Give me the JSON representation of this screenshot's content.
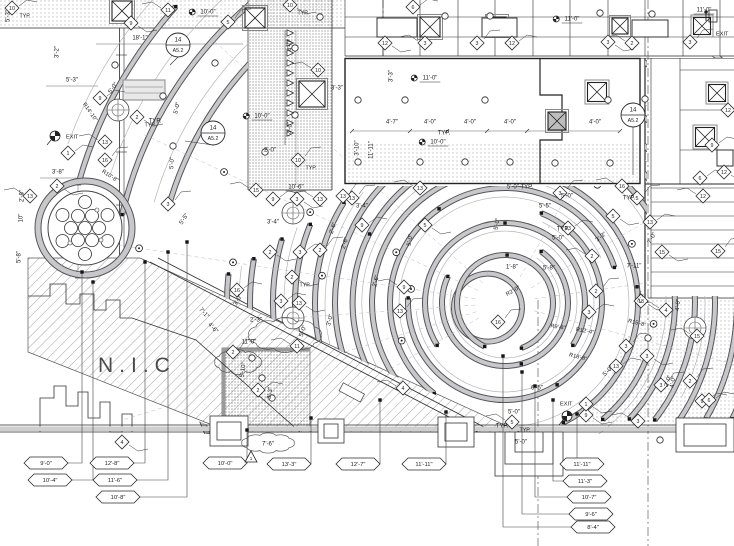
{
  "labels": {
    "nic": "N.I.C",
    "typ": "TYP."
  },
  "revision": {
    "dim": "7'-6\"",
    "delta": "1"
  },
  "detail_tags": [
    {
      "num": "14",
      "sheet": "A5.2",
      "x": 178,
      "y": 45
    },
    {
      "num": "14",
      "sheet": "A5.2",
      "x": 213,
      "y": 133
    },
    {
      "num": "14",
      "sheet": "A5.2",
      "x": 633,
      "y": 115
    }
  ],
  "exits": [
    {
      "label": "EXIT",
      "x": 66,
      "y": 137,
      "sx": 55,
      "sy": 136,
      "style": "dot"
    },
    {
      "label": "EXIT",
      "x": 560,
      "y": 404,
      "sx": 567,
      "sy": 416,
      "style": "dot"
    },
    {
      "label": "EXIT",
      "x": 716,
      "y": 34,
      "sx": 712,
      "sy": 16,
      "style": "person"
    }
  ],
  "diamonds": [
    {
      "n": "10",
      "x": 12,
      "y": 8,
      "typ": true
    },
    {
      "n": "9",
      "x": 131,
      "y": 23
    },
    {
      "n": "11",
      "x": 168,
      "y": 10
    },
    {
      "n": "5",
      "x": 228,
      "y": 22
    },
    {
      "n": "6",
      "x": 413,
      "y": 7
    },
    {
      "n": "12",
      "x": 385,
      "y": 43
    },
    {
      "n": "3",
      "x": 425,
      "y": 43
    },
    {
      "n": "3",
      "x": 477,
      "y": 43
    },
    {
      "n": "12",
      "x": 512,
      "y": 43
    },
    {
      "n": "3",
      "x": 608,
      "y": 42
    },
    {
      "n": "2",
      "x": 632,
      "y": 43
    },
    {
      "n": "3",
      "x": 690,
      "y": 42
    },
    {
      "n": "12",
      "x": 728,
      "y": 110
    },
    {
      "n": "10",
      "x": 290,
      "y": 5,
      "typ": true
    },
    {
      "n": "10",
      "x": 318,
      "y": 70
    },
    {
      "n": "10",
      "x": 298,
      "y": 160,
      "typ": true
    },
    {
      "n": "9",
      "x": 273,
      "y": 199
    },
    {
      "n": "3",
      "x": 297,
      "y": 199
    },
    {
      "n": "13",
      "x": 320,
      "y": 199
    },
    {
      "n": "13",
      "x": 352,
      "y": 198
    },
    {
      "n": "9",
      "x": 100,
      "y": 98
    },
    {
      "n": "2",
      "x": 137,
      "y": 117,
      "typ": true
    },
    {
      "n": "13",
      "x": 105,
      "y": 142
    },
    {
      "n": "16",
      "x": 105,
      "y": 160
    },
    {
      "n": "1",
      "x": 68,
      "y": 153
    },
    {
      "n": "2",
      "x": 57,
      "y": 186
    },
    {
      "n": "13",
      "x": 30,
      "y": 196
    },
    {
      "n": "3",
      "x": 168,
      "y": 204
    },
    {
      "n": "16",
      "x": 237,
      "y": 290
    },
    {
      "n": "2",
      "x": 270,
      "y": 252
    },
    {
      "n": "15",
      "x": 256,
      "y": 190
    },
    {
      "n": "13",
      "x": 343,
      "y": 196
    },
    {
      "n": "9",
      "x": 362,
      "y": 225
    },
    {
      "n": "5",
      "x": 425,
      "y": 225
    },
    {
      "n": "13",
      "x": 420,
      "y": 188
    },
    {
      "n": "2",
      "x": 320,
      "y": 250
    },
    {
      "n": "3",
      "x": 300,
      "y": 252
    },
    {
      "n": "2",
      "x": 292,
      "y": 277,
      "typ": true
    },
    {
      "n": "9",
      "x": 404,
      "y": 287
    },
    {
      "n": "13",
      "x": 400,
      "y": 311
    },
    {
      "n": "3",
      "x": 281,
      "y": 301
    },
    {
      "n": "13",
      "x": 299,
      "y": 303
    },
    {
      "n": "11",
      "x": 297,
      "y": 346
    },
    {
      "n": "2",
      "x": 233,
      "y": 352
    },
    {
      "n": "2",
      "x": 258,
      "y": 390
    },
    {
      "n": "4",
      "x": 122,
      "y": 442
    },
    {
      "n": "4",
      "x": 403,
      "y": 388
    },
    {
      "n": "3",
      "x": 560,
      "y": 193
    },
    {
      "n": "13",
      "x": 568,
      "y": 228
    },
    {
      "n": "5",
      "x": 613,
      "y": 216
    },
    {
      "n": "16",
      "x": 622,
      "y": 186
    },
    {
      "n": "5",
      "x": 637,
      "y": 198
    },
    {
      "n": "13",
      "x": 650,
      "y": 222
    },
    {
      "n": "15",
      "x": 662,
      "y": 252
    },
    {
      "n": "2",
      "x": 592,
      "y": 256
    },
    {
      "n": "2",
      "x": 596,
      "y": 291
    },
    {
      "n": "3",
      "x": 589,
      "y": 312
    },
    {
      "n": "13",
      "x": 641,
      "y": 301
    },
    {
      "n": "4",
      "x": 666,
      "y": 310
    },
    {
      "n": "3",
      "x": 626,
      "y": 346
    },
    {
      "n": "13",
      "x": 616,
      "y": 366
    },
    {
      "n": "3",
      "x": 647,
      "y": 356
    },
    {
      "n": "15",
      "x": 697,
      "y": 336
    },
    {
      "n": "2",
      "x": 690,
      "y": 381
    },
    {
      "n": "9",
      "x": 702,
      "y": 401
    },
    {
      "n": "9",
      "x": 586,
      "y": 415
    },
    {
      "n": "3",
      "x": 638,
      "y": 421
    },
    {
      "n": "3",
      "x": 661,
      "y": 385
    },
    {
      "n": "6",
      "x": 709,
      "y": 400
    },
    {
      "n": "1",
      "x": 586,
      "y": 404
    },
    {
      "n": "5",
      "x": 512,
      "y": 422,
      "typ": true
    },
    {
      "n": "16",
      "x": 498,
      "y": 322
    },
    {
      "n": "6",
      "x": 700,
      "y": 178
    },
    {
      "n": "12",
      "x": 724,
      "y": 172
    },
    {
      "n": "12",
      "x": 703,
      "y": 196
    },
    {
      "n": "15",
      "x": 718,
      "y": 251
    },
    {
      "n": "9",
      "x": 712,
      "y": 145
    }
  ],
  "dims": [
    {
      "t": "18'-1\"",
      "x": 140,
      "y": 38
    },
    {
      "t": "5'-3\"",
      "x": 72,
      "y": 80
    },
    {
      "t": "3'-2\"",
      "x": 57,
      "y": 52,
      "r": -90
    },
    {
      "t": "5'-0\"",
      "x": 113,
      "y": 88,
      "r": -55
    },
    {
      "t": "5'-0\"",
      "x": 177,
      "y": 108,
      "r": -78
    },
    {
      "t": "5'-0\"",
      "x": 172,
      "y": 163,
      "r": -86
    },
    {
      "t": "3'-8\"",
      "x": 58,
      "y": 172
    },
    {
      "t": "10'-0\"",
      "x": 208,
      "y": 12,
      "u": 1,
      "d": 1
    },
    {
      "t": "5'-3\"",
      "x": 8,
      "y": 16,
      "r": -90
    },
    {
      "t": "10'-0\"",
      "x": 262,
      "y": 116,
      "u": 1,
      "d": 1
    },
    {
      "t": "2'-0\"",
      "x": 270,
      "y": 150
    },
    {
      "t": "10'-6\"",
      "x": 296,
      "y": 187,
      "u": 1
    },
    {
      "t": "3'-3\"",
      "x": 337,
      "y": 88
    },
    {
      "t": "4'-0\"",
      "x": 290,
      "y": 45,
      "r": -90
    },
    {
      "t": "4'-0\"",
      "x": 290,
      "y": 128,
      "r": -90
    },
    {
      "t": "11'-0\"",
      "x": 430,
      "y": 78,
      "u": 1,
      "d": 1
    },
    {
      "t": "3'-3\"",
      "x": 391,
      "y": 76,
      "r": -90
    },
    {
      "t": "4'-7\"",
      "x": 392,
      "y": 122
    },
    {
      "t": "4'-0\"",
      "x": 430,
      "y": 122
    },
    {
      "t": "4'-0\"",
      "x": 470,
      "y": 122
    },
    {
      "t": "4'-0\"",
      "x": 510,
      "y": 122
    },
    {
      "t": "4'-0\"",
      "x": 595,
      "y": 122
    },
    {
      "t": "3'-10\"",
      "x": 357,
      "y": 148,
      "r": -90
    },
    {
      "t": "11'-11\"",
      "x": 371,
      "y": 150,
      "r": -90
    },
    {
      "t": "10'-0\"",
      "x": 438,
      "y": 142,
      "u": 1,
      "d": 1
    },
    {
      "t": "11'-0\"",
      "x": 572,
      "y": 19,
      "u": 1,
      "d": 1
    },
    {
      "t": "11'-0\"",
      "x": 704,
      "y": 10,
      "u": 1
    },
    {
      "t": "3'-4\"",
      "x": 273,
      "y": 222
    },
    {
      "t": "2'-6\"",
      "x": 333,
      "y": 228,
      "r": -72
    },
    {
      "t": "2'-6\"",
      "x": 345,
      "y": 243,
      "r": -72
    },
    {
      "t": "3'-4\"",
      "x": 362,
      "y": 206
    },
    {
      "t": "2'-6\"",
      "x": 376,
      "y": 281,
      "r": -76
    },
    {
      "t": "3'-0\"",
      "x": 330,
      "y": 320,
      "r": -76
    },
    {
      "t": "5'-0\"",
      "x": 303,
      "y": 331,
      "r": -70
    },
    {
      "t": "2'-3\"",
      "x": 256,
      "y": 320
    },
    {
      "t": "11'-0\"",
      "x": 249,
      "y": 342
    },
    {
      "t": "3'-0\"",
      "x": 238,
      "y": 300,
      "r": -60
    },
    {
      "t": "5'-0\" TYP.",
      "x": 520,
      "y": 187
    },
    {
      "t": "5'-0\"",
      "x": 567,
      "y": 196
    },
    {
      "t": "TYP.",
      "x": 629,
      "y": 198
    },
    {
      "t": "5'-5\"",
      "x": 545,
      "y": 206
    },
    {
      "t": "5'-0\"",
      "x": 558,
      "y": 238
    },
    {
      "t": "3'-3\"",
      "x": 601,
      "y": 237,
      "r": -38
    },
    {
      "t": "5'-8\"",
      "x": 549,
      "y": 268
    },
    {
      "t": "1'-8\"",
      "x": 512,
      "y": 267
    },
    {
      "t": "7'-11\"",
      "x": 634,
      "y": 266
    },
    {
      "t": "2'-2\"",
      "x": 641,
      "y": 297,
      "r": -75
    },
    {
      "t": "7'-0\"",
      "x": 652,
      "y": 238,
      "r": -62
    },
    {
      "t": "4'-0\"",
      "x": 678,
      "y": 305,
      "r": -85
    },
    {
      "t": "4'-0\"",
      "x": 673,
      "y": 382,
      "r": -80
    },
    {
      "t": "5'-5\"",
      "x": 184,
      "y": 219,
      "r": -58
    },
    {
      "t": "7'-1\"",
      "x": 204,
      "y": 313,
      "r": 48
    },
    {
      "t": "4'-6\"",
      "x": 213,
      "y": 328,
      "r": 48
    },
    {
      "t": "2'-8\"",
      "x": 22,
      "y": 196,
      "r": -90
    },
    {
      "t": "10\"",
      "x": 21,
      "y": 218,
      "r": -90
    },
    {
      "t": "5'-8\"",
      "x": 19,
      "y": 257,
      "r": -90
    },
    {
      "t": "5'-10\"",
      "x": 243,
      "y": 370,
      "r": -82
    },
    {
      "t": "3'-3\"",
      "x": 270,
      "y": 393,
      "r": -82
    },
    {
      "t": "6'-5\"",
      "x": 537,
      "y": 388
    },
    {
      "t": "5'-0\"",
      "x": 514,
      "y": 412
    },
    {
      "t": "5'-0\"",
      "x": 521,
      "y": 442
    },
    {
      "t": "2'-0\"",
      "x": 668,
      "y": 381,
      "r": -72
    },
    {
      "t": "5'-0\"",
      "x": 608,
      "y": 371,
      "r": -45
    },
    {
      "t": "TYP.",
      "x": 444,
      "y": 133
    },
    {
      "t": "TYP.",
      "x": 155,
      "y": 121
    },
    {
      "t": "5'-0\"",
      "x": 497,
      "y": 224,
      "r": -80
    },
    {
      "t": "TYP.",
      "x": 502,
      "y": 426
    },
    {
      "t": "TYP.",
      "x": 563,
      "y": 229
    },
    {
      "t": "5'-0\"",
      "x": 410,
      "y": 240,
      "r": -80
    }
  ],
  "radius_labels": [
    {
      "t": "R14'-10\"",
      "x": 90,
      "y": 112,
      "r": 55
    },
    {
      "t": "R10'-8\"",
      "x": 110,
      "y": 176,
      "r": 33
    },
    {
      "t": "R15'-8\"",
      "x": 637,
      "y": 323,
      "r": 14
    },
    {
      "t": "R12'-4\"",
      "x": 585,
      "y": 331,
      "r": 10
    },
    {
      "t": "R18'-8\"",
      "x": 578,
      "y": 357,
      "r": 14
    },
    {
      "t": "R9'-8\"",
      "x": 558,
      "y": 327,
      "r": 8
    },
    {
      "t": "R2'-0\"",
      "x": 513,
      "y": 291,
      "r": -30
    }
  ],
  "elevation_tags": [
    {
      "t": "9'-0\"",
      "x": 46,
      "y": 463,
      "lx": 82,
      "ly": 272,
      "side": "r"
    },
    {
      "t": "10'-4\"",
      "x": 50,
      "y": 480,
      "lx": 93,
      "ly": 282,
      "side": "r"
    },
    {
      "t": "12'-8\"",
      "x": 112,
      "y": 463,
      "lx": 145,
      "ly": 262,
      "side": "r"
    },
    {
      "t": "11'-6\"",
      "x": 115,
      "y": 480,
      "lx": 168,
      "ly": 252,
      "side": "r"
    },
    {
      "t": "10'-8\"",
      "x": 118,
      "y": 497,
      "lx": 187,
      "ly": 242,
      "side": "r"
    },
    {
      "t": "10'-0\"",
      "x": 225,
      "y": 463,
      "lx": 247,
      "ly": 430,
      "side": "r"
    },
    {
      "t": "13'-3\"",
      "x": 289,
      "y": 464,
      "lx": 311,
      "ly": 418,
      "side": "r"
    },
    {
      "t": "12'-7\"",
      "x": 358,
      "y": 464,
      "lx": 380,
      "ly": 400,
      "side": "r"
    },
    {
      "t": "11'-11\"",
      "x": 424,
      "y": 464,
      "lx": 446,
      "ly": 412,
      "side": "r"
    },
    {
      "t": "11'-11\"",
      "x": 582,
      "y": 464,
      "lx": 577,
      "ly": 414,
      "side": "l"
    },
    {
      "t": "11'-3\"",
      "x": 585,
      "y": 481,
      "lx": 553,
      "ly": 400,
      "side": "l"
    },
    {
      "t": "10'-7\"",
      "x": 589,
      "y": 497,
      "lx": 535,
      "ly": 386,
      "side": "l"
    },
    {
      "t": "9'-6\"",
      "x": 591,
      "y": 514,
      "lx": 522,
      "ly": 372,
      "side": "l"
    },
    {
      "t": "8'-4\"",
      "x": 593,
      "y": 527,
      "lx": 503,
      "ly": 356,
      "side": "l"
    }
  ]
}
